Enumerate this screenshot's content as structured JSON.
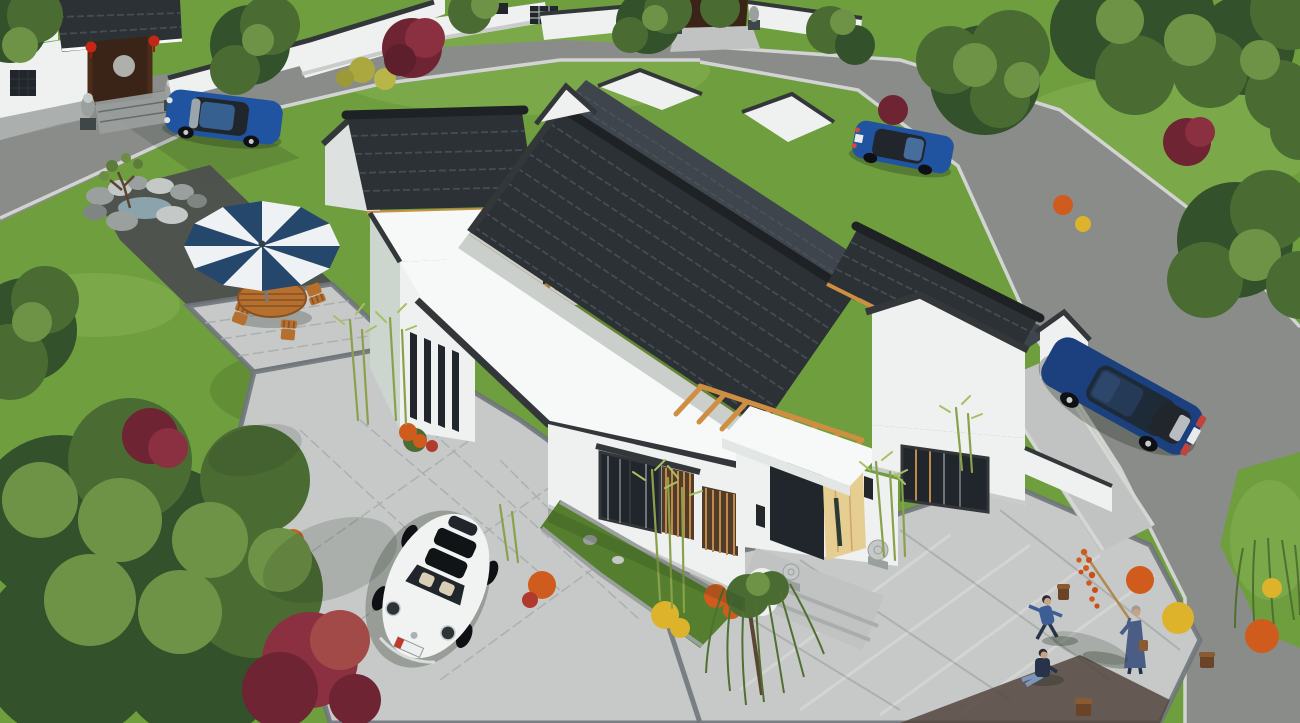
{
  "meta": {
    "alt": "Aerial 3D rendering of a modern Chinese-style single-storey courtyard house with white walls and charcoal tiled gable roofs, set in a landscaped residential compound with roads, parked cars, a patio umbrella, rockery pond, bamboo, flower shrubs and people playing on the paved yard",
    "width": 1300,
    "height": 723
  },
  "palette": {
    "grass": "#6f9e3e",
    "grass-light": "#8ab356",
    "grass-dark": "#557f2e",
    "road": "#8a8c8a",
    "asphalt-dark": "#4b4d4f",
    "sidewalk": "#c0c3c1",
    "curb": "#d6d8d6",
    "paver": "#c6c9c8",
    "paver-line": "#a6abab",
    "paver-band": "#70767a",
    "roof-dark": "#2c3135",
    "roof-back": "#3e454c",
    "roof-hi": "#4e565e",
    "roof-ridge": "#1e2225",
    "trim": "#33373a",
    "wood": "#cf8f43",
    "wood-light": "#e6cd92",
    "glass": "#20262b",
    "wall-white": "#eef1f0",
    "wall-bright": "#f7f9f8",
    "wall-shade": "#dde2e0",
    "wall-green": "#ccd6cf",
    "stone": "#9aa09e",
    "stone-light": "#c4c8c6",
    "water": "#8ba3ad",
    "umbrella-navy": "#25476c",
    "umbrella-white": "#eff2f4",
    "furniture": "#b5702f",
    "furniture-dark": "#8a5121",
    "car-blue": "#2154a0",
    "car-blue-dark": "#1c3f7e",
    "car-white": "#f1f3f2",
    "tree-dark": "#33512a",
    "tree-mid": "#4a6c33",
    "tree-light": "#6f9346",
    "tree-red": "#6e2433",
    "tree-red-light": "#8a3040",
    "bamboo": "#8aa14c",
    "bamboo-leaf": "#a9bf63",
    "flower-yellow": "#ddb32c",
    "flower-orange": "#cf5c1d",
    "flower-red": "#b03a2e",
    "skin": "#caa183",
    "people-blue": "#3d5d95",
    "people-dark": "#283349",
    "willow": "#4f7030",
    "shadow": "#1f2a1c",
    "lantern": "#c22717",
    "door-wood": "#3a2417"
  },
  "scene": {
    "setting": {
      "label": "landscaped residential compound with lawns, trees and grey roads"
    },
    "front_gate": {
      "label": "traditional gate with tiled roof, red lanterns and stone lions"
    },
    "neighbor_gate": {
      "label": "second compound gate with stone lions at top of street"
    },
    "street": {
      "label": "grey asphalt street with light curbs"
    },
    "courtyard": {
      "label": "light grey paver courtyard and driveway"
    },
    "rock_garden": {
      "label": "rockery stones with small pond and sapling"
    },
    "main_house": {
      "label": "white courtyard house with charcoal tile gable roofs, flat white roofs and timber pergolas"
    },
    "entrance": {
      "label": "open light-timber entry door under white canopy flanked by stone drums and bamboo"
    },
    "patio_umbrella": {
      "label": "blue and white striped parasol"
    },
    "patio_set": {
      "label": "wooden outdoor table with four folding chairs"
    },
    "car_sedan_gate": {
      "label": "blue sedan parked at the gate"
    },
    "car_sedan_street": {
      "label": "blue sedan driving on the upper street"
    },
    "car_passat": {
      "label": "dark blue saloon parked on the side road"
    },
    "car_beetle": {
      "label": "white Beetle parked on the courtyard pavers"
    },
    "grandfather": {
      "label": "elderly man in blue holding a pole of candied haw sticks"
    },
    "running_child": {
      "label": "child in blue running across the pavers"
    },
    "sitting_child": {
      "label": "child sitting on the pavers"
    },
    "willow": {
      "label": "weeping willow at the courtyard edge"
    },
    "flowers": {
      "label": "orange, yellow and red flowering shrubs"
    }
  }
}
